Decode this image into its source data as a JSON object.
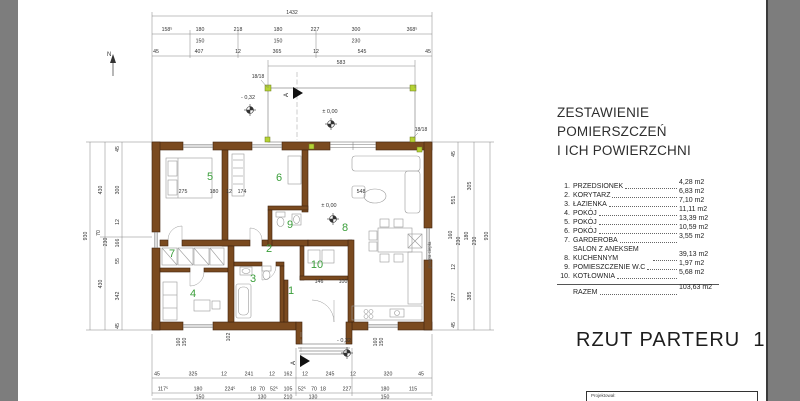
{
  "schedule": {
    "title_line1": "ZESTAWIENIE POMIERSZCZEŃ",
    "title_line2": "I ICH POWIERZCHNI",
    "rows": [
      {
        "num": "1.",
        "label": "PRZEDSIONEK",
        "area": "4,28 m2"
      },
      {
        "num": "2.",
        "label": "KORYTARZ",
        "area": "6,83 m2"
      },
      {
        "num": "3.",
        "label": "ŁAZIENKA",
        "area": "7,10 m2"
      },
      {
        "num": "4.",
        "label": "POKÓJ",
        "area": "11,11 m2"
      },
      {
        "num": "5.",
        "label": "POKÓJ",
        "area": "13,39 m2"
      },
      {
        "num": "6.",
        "label": "POKÓJ",
        "area": "10,59 m2"
      },
      {
        "num": "7.",
        "label": "GARDEROBA",
        "area": "3,55 m2"
      },
      {
        "num": "8.",
        "label": "SALON Z ANEKSEM KUCHENNYM",
        "area": "39,13 m2"
      },
      {
        "num": "9.",
        "label": "POMIESZCZENIE W.C",
        "area": "1,97 m2"
      },
      {
        "num": "10.",
        "label": "KOTŁOWNIA",
        "area": "5,68 m2"
      }
    ],
    "total_label": "RAZEM",
    "total_area": "103,63 m2"
  },
  "drawing_title": "RZUT PARTERU  1:100",
  "titleblock": {
    "label": "Projektował:"
  },
  "plan": {
    "north": "N",
    "section": "A",
    "column_size": "18/18",
    "levels": {
      "zero": "± 0,00",
      "minus": "- 0,32"
    },
    "note_vertical": "pompa ciepła",
    "rooms": {
      "r1": "1",
      "r2": "2",
      "r3": "3",
      "r4": "4",
      "r5": "5",
      "r6": "6",
      "r7": "7",
      "r8": "8",
      "r9": "9",
      "r10": "10"
    },
    "dims": {
      "top_total": "1432",
      "top2": [
        "158⁵",
        "180",
        "218",
        "180",
        "227",
        "300",
        "368⁵"
      ],
      "top3": [
        "150",
        "150",
        "230"
      ],
      "top4": [
        "45",
        "407",
        "12",
        "365",
        "12",
        "545",
        "45"
      ],
      "terrace_width": "583",
      "left_outer": "930",
      "left2": [
        "430",
        "70",
        "230",
        "430"
      ],
      "left3": [
        "45",
        "300",
        "12",
        "166",
        "55",
        "342",
        "45"
      ],
      "right1": [
        "45",
        "551",
        "160",
        "230",
        "12",
        "277",
        "45"
      ],
      "right2": [
        "305",
        "180",
        "230",
        "385"
      ],
      "right_outer": "930",
      "bottom1": [
        "45",
        "325",
        "12",
        "241",
        "12",
        "162",
        "12",
        "245",
        "12",
        "320",
        "45"
      ],
      "bottom2": [
        "117⁵",
        "180",
        "224⁵",
        "18",
        "70",
        "52⁵",
        "105",
        "52⁵",
        "70",
        "18",
        "227",
        "180",
        "115"
      ],
      "bottom3": [
        "150",
        "130",
        "210",
        "130",
        "150"
      ],
      "inner_mid": [
        "275",
        "180",
        "12",
        "174",
        "548"
      ],
      "room10": [
        "146",
        "100"
      ],
      "porch_left": [
        "160",
        "150"
      ],
      "porch_right": [
        "160",
        "150"
      ],
      "porch_depth": "102"
    },
    "colors": {
      "wall": "#7a4a1f",
      "room_number": "#3a9e3a",
      "column_marker": "#b5d334",
      "surround_gray": "#7d7d7d"
    }
  }
}
